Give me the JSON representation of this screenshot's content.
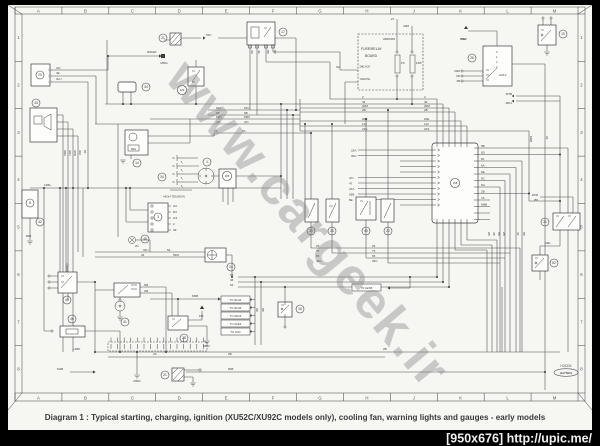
{
  "page": {
    "caption": "Diagram 1 : Typical starting, charging, ignition (XU52C/XU92C models only), cooling fan, warning lights and gauges - early models",
    "watermark": "www.cargeek.ir",
    "footer_url": "[950x676] http://upic.me/",
    "doc_number": "H24334",
    "publisher": "HAYNES"
  },
  "grid": {
    "cols": [
      "A",
      "B",
      "C",
      "D",
      "E",
      "F",
      "G",
      "H",
      "J",
      "K",
      "L",
      "M"
    ],
    "rows": [
      "1",
      "2",
      "3",
      "4",
      "5",
      "6",
      "7",
      "8"
    ]
  },
  "board": {
    "title_line1": "FUSE/RELAY",
    "title_line2": "BOARD",
    "tag_top": "3/BROWN",
    "tag_mid": "2/BLACK",
    "tag_bottom": "1/WHITE",
    "fuse1": "F5",
    "fuse2": "F1B"
  },
  "labels": {
    "high_tension": "HIGH TENSION",
    "ign_switch": "H3/L2",
    "ph2": "PH2",
    "reg": "REG"
  },
  "callouts": [
    {
      "n": "20",
      "x": 40,
      "y": 75
    },
    {
      "n": "43",
      "x": 36,
      "y": 103
    },
    {
      "n": "8",
      "x": 30,
      "y": 203
    },
    {
      "n": "42",
      "x": 40,
      "y": 222
    },
    {
      "n": "44",
      "x": 146,
      "y": 87
    },
    {
      "n": "21",
      "x": 163,
      "y": 38
    },
    {
      "n": "123",
      "x": 182,
      "y": 90
    },
    {
      "n": "17",
      "x": 283,
      "y": 32
    },
    {
      "n": "14",
      "x": 137,
      "y": 163
    },
    {
      "n": "34",
      "x": 162,
      "y": 177
    },
    {
      "n": "1",
      "x": 207,
      "y": 162
    },
    {
      "n": "185",
      "x": 227,
      "y": 176
    },
    {
      "n": "3",
      "x": 158,
      "y": 217
    },
    {
      "n": "48",
      "x": 145,
      "y": 239
    },
    {
      "n": "24",
      "x": 231,
      "y": 267
    },
    {
      "n": "45",
      "x": 67,
      "y": 300
    },
    {
      "n": "46",
      "x": 72,
      "y": 319
    },
    {
      "n": "41",
      "x": 125,
      "y": 322
    },
    {
      "n": "28",
      "x": 184,
      "y": 338
    },
    {
      "n": "15",
      "x": 300,
      "y": 309
    },
    {
      "n": "21",
      "x": 165,
      "y": 375
    },
    {
      "n": "29",
      "x": 311,
      "y": 231
    },
    {
      "n": "25",
      "x": 332,
      "y": 231
    },
    {
      "n": "40",
      "x": 366,
      "y": 231
    },
    {
      "n": "22",
      "x": 388,
      "y": 231
    },
    {
      "n": "158",
      "x": 455,
      "y": 183
    },
    {
      "n": "26",
      "x": 472,
      "y": 58
    },
    {
      "n": "10",
      "x": 563,
      "y": 34
    },
    {
      "n": "31",
      "x": 545,
      "y": 222
    },
    {
      "n": "52",
      "x": 554,
      "y": 263
    }
  ],
  "wire_labels": [
    {
      "t": "4/C",
      "x": 56,
      "y": 69
    },
    {
      "t": "4E",
      "x": 56,
      "y": 74
    },
    {
      "t": "3LU",
      "x": 56,
      "y": 80
    },
    {
      "t": "RWGR",
      "x": 147,
      "y": 53
    },
    {
      "t": "MMG",
      "x": 164,
      "y": 64,
      "a": "middle"
    },
    {
      "t": "63C",
      "x": 206,
      "y": 36
    },
    {
      "t": "12Bu",
      "x": 44,
      "y": 186
    },
    {
      "t": "B06",
      "x": 26,
      "y": 237
    },
    {
      "t": "63C",
      "x": 216,
      "y": 109
    },
    {
      "t": "6B",
      "x": 216,
      "y": 114
    },
    {
      "t": "M6X",
      "x": 216,
      "y": 118
    },
    {
      "t": "4/C",
      "x": 216,
      "y": 123
    },
    {
      "t": "7A",
      "x": 214,
      "y": 132
    },
    {
      "t": "63C",
      "x": 244,
      "y": 109
    },
    {
      "t": "6B",
      "x": 244,
      "y": 114
    },
    {
      "t": "M6X",
      "x": 244,
      "y": 118
    },
    {
      "t": "4/C",
      "x": 244,
      "y": 123
    },
    {
      "t": "7A",
      "x": 242,
      "y": 132
    },
    {
      "t": "2",
      "x": 362,
      "y": 98
    },
    {
      "t": "46",
      "x": 362,
      "y": 103
    },
    {
      "t": "30M",
      "x": 362,
      "y": 107
    },
    {
      "t": "2B",
      "x": 362,
      "y": 111
    },
    {
      "t": "20E",
      "x": 362,
      "y": 120
    },
    {
      "t": "112",
      "x": 362,
      "y": 125
    },
    {
      "t": "22S",
      "x": 362,
      "y": 130
    },
    {
      "t": "2",
      "x": 424,
      "y": 98
    },
    {
      "t": "46",
      "x": 424,
      "y": 103
    },
    {
      "t": "30M",
      "x": 424,
      "y": 107
    },
    {
      "t": "2B",
      "x": 424,
      "y": 111
    },
    {
      "t": "20E",
      "x": 424,
      "y": 120
    },
    {
      "t": "112",
      "x": 424,
      "y": 125
    },
    {
      "t": "22S",
      "x": 424,
      "y": 130
    },
    {
      "t": "22A",
      "x": 351,
      "y": 151.5
    },
    {
      "t": "30C",
      "x": 351,
      "y": 157
    },
    {
      "t": "4/C",
      "x": 349,
      "y": 179
    },
    {
      "t": "47",
      "x": 349,
      "y": 184.5
    },
    {
      "t": "47A",
      "x": 349,
      "y": 190
    },
    {
      "t": "26B",
      "x": 349,
      "y": 195.5
    },
    {
      "t": "8E",
      "x": 349,
      "y": 201
    },
    {
      "t": "2J",
      "x": 394,
      "y": 20,
      "a": "end"
    },
    {
      "t": "30M",
      "x": 409,
      "y": 27,
      "a": "end"
    },
    {
      "t": "S2",
      "x": 336,
      "y": 68
    },
    {
      "t": "30M",
      "x": 460,
      "y": 72,
      "a": "end"
    },
    {
      "t": "2D",
      "x": 460,
      "y": 77,
      "a": "end"
    },
    {
      "t": "4B",
      "x": 460,
      "y": 82,
      "a": "end"
    },
    {
      "t": "M7B",
      "x": 512,
      "y": 95,
      "a": "end"
    },
    {
      "t": "MD1",
      "x": 512,
      "y": 104,
      "a": "end"
    },
    {
      "t": "E5R",
      "x": 538,
      "y": 196,
      "a": "end"
    },
    {
      "t": "B5",
      "x": 538,
      "y": 201,
      "a": "end"
    },
    {
      "t": "M6L",
      "x": 545,
      "y": 244
    },
    {
      "t": "6B",
      "x": 481,
      "y": 147
    },
    {
      "t": "6D",
      "x": 481,
      "y": 153.5
    },
    {
      "t": "6F",
      "x": 481,
      "y": 160
    },
    {
      "t": "6A",
      "x": 481,
      "y": 166.5
    },
    {
      "t": "6E",
      "x": 481,
      "y": 173
    },
    {
      "t": "6C",
      "x": 481,
      "y": 179.5
    },
    {
      "t": "6G",
      "x": 481,
      "y": 186
    },
    {
      "t": "2B",
      "x": 481,
      "y": 192.5
    },
    {
      "t": "7A",
      "x": 481,
      "y": 199
    },
    {
      "t": "M6B",
      "x": 481,
      "y": 205.5
    },
    {
      "t": "2H",
      "x": 173,
      "y": 207
    },
    {
      "t": "D3",
      "x": 173,
      "y": 213
    },
    {
      "t": "G3",
      "x": 173,
      "y": 219
    },
    {
      "t": "2",
      "x": 173,
      "y": 225
    },
    {
      "t": "3Z",
      "x": 173,
      "y": 231
    },
    {
      "t": "5M",
      "x": 144,
      "y": 286
    },
    {
      "t": "2M",
      "x": 144,
      "y": 292
    },
    {
      "t": "FM",
      "x": 199,
      "y": 317
    },
    {
      "t": "MM3",
      "x": 203,
      "y": 347
    },
    {
      "t": "2C",
      "x": 135,
      "y": 247
    },
    {
      "t": "32U",
      "x": 143,
      "y": 251
    },
    {
      "t": "52",
      "x": 167,
      "y": 251
    },
    {
      "t": "32",
      "x": 141,
      "y": 256
    },
    {
      "t": "52M",
      "x": 173,
      "y": 256
    },
    {
      "t": "52",
      "x": 230,
      "y": 276
    },
    {
      "t": "46",
      "x": 230,
      "y": 281
    },
    {
      "t": "52",
      "x": 230,
      "y": 286
    },
    {
      "t": "M6B",
      "x": 192,
      "y": 297
    },
    {
      "t": "25",
      "x": 316,
      "y": 247
    },
    {
      "t": "75",
      "x": 316,
      "y": 252
    },
    {
      "t": "65",
      "x": 316,
      "y": 257
    },
    {
      "t": "36C",
      "x": 316,
      "y": 262
    },
    {
      "t": "25",
      "x": 372,
      "y": 247
    },
    {
      "t": "75",
      "x": 372,
      "y": 252
    },
    {
      "t": "65",
      "x": 372,
      "y": 257
    },
    {
      "t": "36C",
      "x": 372,
      "y": 262
    },
    {
      "t": "2A",
      "x": 153,
      "y": 355
    },
    {
      "t": "2B",
      "x": 228,
      "y": 355
    },
    {
      "t": "2B",
      "x": 383,
      "y": 350
    },
    {
      "t": "60B",
      "x": 228,
      "y": 370
    },
    {
      "t": "M1B",
      "x": 57,
      "y": 370
    },
    {
      "t": "MMG",
      "x": 137,
      "y": 382,
      "a": "middle"
    },
    {
      "t": "L2BK",
      "x": 73,
      "y": 350
    },
    {
      "t": "PH2",
      "x": 461,
      "y": 40
    },
    {
      "t": "6MX",
      "x": 64,
      "y": 150,
      "r": 90
    },
    {
      "t": "30D",
      "x": 69,
      "y": 150,
      "r": 90
    },
    {
      "t": "3DD",
      "x": 74,
      "y": 150,
      "r": 90
    },
    {
      "t": "30Z",
      "x": 79,
      "y": 150,
      "r": 90
    },
    {
      "t": "8Z",
      "x": 84,
      "y": 150,
      "r": 90
    },
    {
      "t": "4D",
      "x": 251,
      "y": 50,
      "r": 90
    },
    {
      "t": "4E",
      "x": 258,
      "y": 50,
      "r": 90
    },
    {
      "t": "8B",
      "x": 267,
      "y": 50,
      "r": 90
    },
    {
      "t": "8D",
      "x": 274,
      "y": 50,
      "r": 90
    },
    {
      "t": "2B",
      "x": 488,
      "y": 232,
      "r": 90
    },
    {
      "t": "3B",
      "x": 493,
      "y": 232,
      "r": 90
    },
    {
      "t": "5B",
      "x": 498,
      "y": 232,
      "r": 90
    },
    {
      "t": "2B",
      "x": 503,
      "y": 232,
      "r": 90
    },
    {
      "t": "4Z",
      "x": 517,
      "y": 232,
      "r": 90
    },
    {
      "t": "5B",
      "x": 523,
      "y": 232,
      "r": 90
    },
    {
      "t": "M2B",
      "x": 530,
      "y": 136,
      "r": 90
    },
    {
      "t": "26",
      "x": 546,
      "y": 136,
      "r": 90
    },
    {
      "t": "6B",
      "x": 256,
      "y": 308,
      "r": 90
    },
    {
      "t": "8B",
      "x": 262,
      "y": 308,
      "r": 90
    },
    {
      "t": "F5",
      "x": 401,
      "y": 64
    },
    {
      "t": "F1B",
      "x": 416,
      "y": 64
    }
  ],
  "to_boxes": [
    {
      "t": "TO 3b/H4",
      "x": 221,
      "y": 296
    },
    {
      "t": "TO 3b/H6",
      "x": 221,
      "y": 304
    },
    {
      "t": "TO 3d/A6",
      "x": 221,
      "y": 312
    },
    {
      "t": "TO 3e/E2",
      "x": 221,
      "y": 320
    },
    {
      "t": "TO 1f/J2",
      "x": 221,
      "y": 328
    },
    {
      "t": "TO 2a/D8",
      "x": 352,
      "y": 284
    }
  ]
}
